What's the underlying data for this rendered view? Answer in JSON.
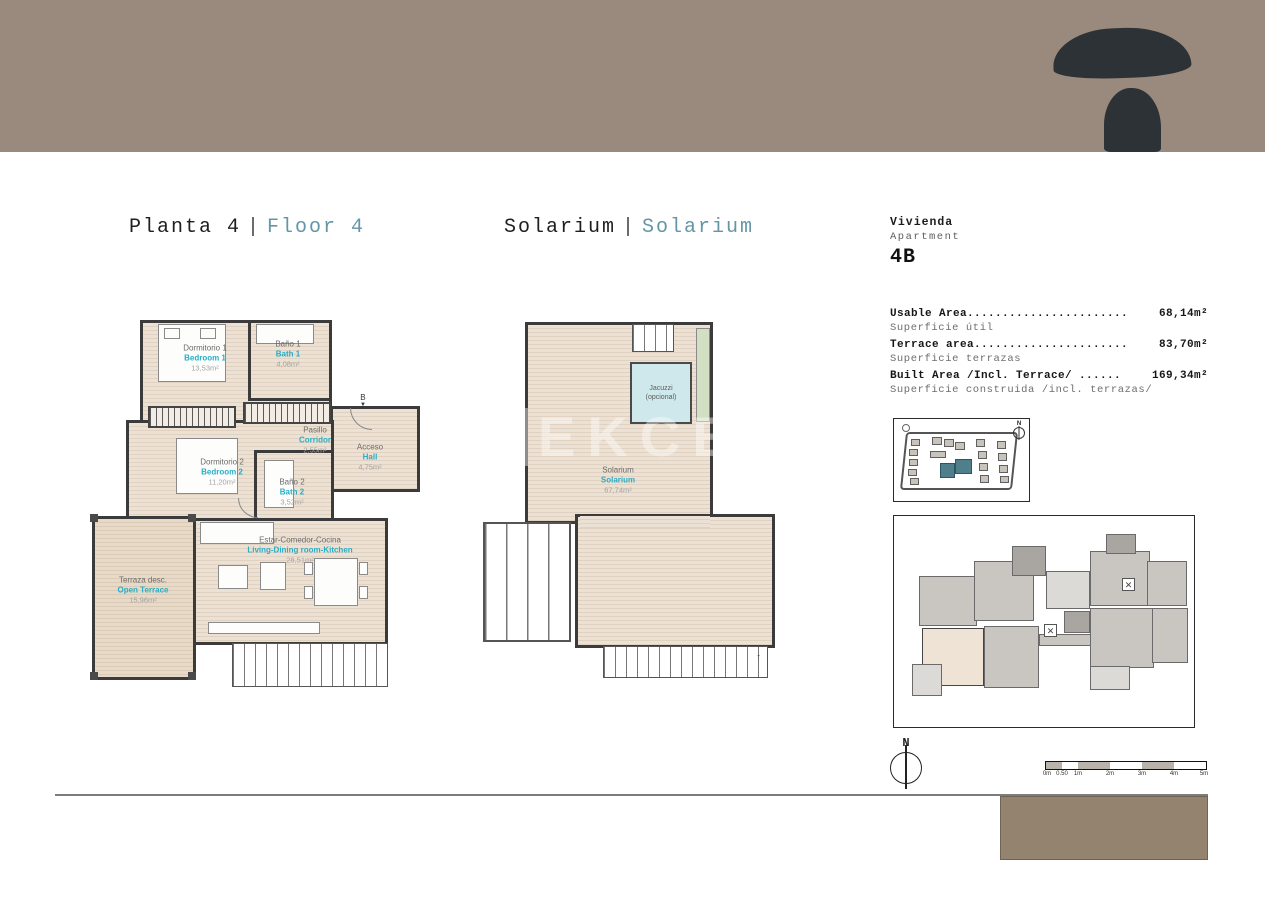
{
  "headings": {
    "floor": {
      "primary": "Planta 4",
      "separator": "|",
      "secondary": "Floor 4"
    },
    "solarium": {
      "primary": "Solarium",
      "separator": "|",
      "secondary": "Solarium"
    }
  },
  "apartment": {
    "label_es": "Vivienda",
    "label_en": "Apartment",
    "unit": "4B",
    "areas": [
      {
        "label_en": "Usable Area.......................",
        "value": "68,14m²",
        "label_es": "Superficie útil"
      },
      {
        "label_en": "Terrace area......................",
        "value": "83,70m²",
        "label_es": "Superficie terrazas"
      },
      {
        "label_en": "Built Area /Incl. Terrace/ ......",
        "value": "169,34m²",
        "label_es": "Superficie construida /incl. terrazas/"
      }
    ]
  },
  "floor_plan": {
    "marker": "B",
    "marker_arrow": "▼",
    "rooms": [
      {
        "es": "Dormitorio 1",
        "en": "Bedroom 1",
        "area": "13,53m²"
      },
      {
        "es": "Baño 1",
        "en": "Bath 1",
        "area": "4,08m²"
      },
      {
        "es": "Pasillo",
        "en": "Corridor",
        "area": "2,55m²"
      },
      {
        "es": "Acceso",
        "en": "Hall",
        "area": "4,75m²"
      },
      {
        "es": "Dormitorio 2",
        "en": "Bedroom 2",
        "area": "11,20m²"
      },
      {
        "es": "Baño 2",
        "en": "Bath 2",
        "area": "3,52m²"
      },
      {
        "es": "Estar-Comedor-Cocina",
        "en": "Living-Dining room-Kitchen",
        "area": "28,51m²"
      },
      {
        "es": "Terraza desc.",
        "en": "Open Terrace",
        "area": "15,96m²"
      }
    ]
  },
  "solarium_plan": {
    "room": {
      "es": "Solarium",
      "en": "Solarium",
      "area": "67,74m²"
    },
    "jacuzzi_line1": "Jacuzzi",
    "jacuzzi_line2": "(opcional)",
    "stairs_arrow": "↑"
  },
  "watermark": {
    "logo": "T",
    "text": "EKCE"
  },
  "compass": {
    "north": "N"
  },
  "scale_bar": {
    "ticks": [
      "0m",
      "0.50",
      "1m",
      "2m",
      "3m",
      "4m",
      "5m"
    ]
  },
  "colors": {
    "band": "#9a8a7d",
    "logo": "#2d3236",
    "heading_accent": "#6496a6",
    "room_accent": "#27aec6",
    "site_highlight": "#4e7f8a",
    "footer_rect": "#93836f"
  }
}
